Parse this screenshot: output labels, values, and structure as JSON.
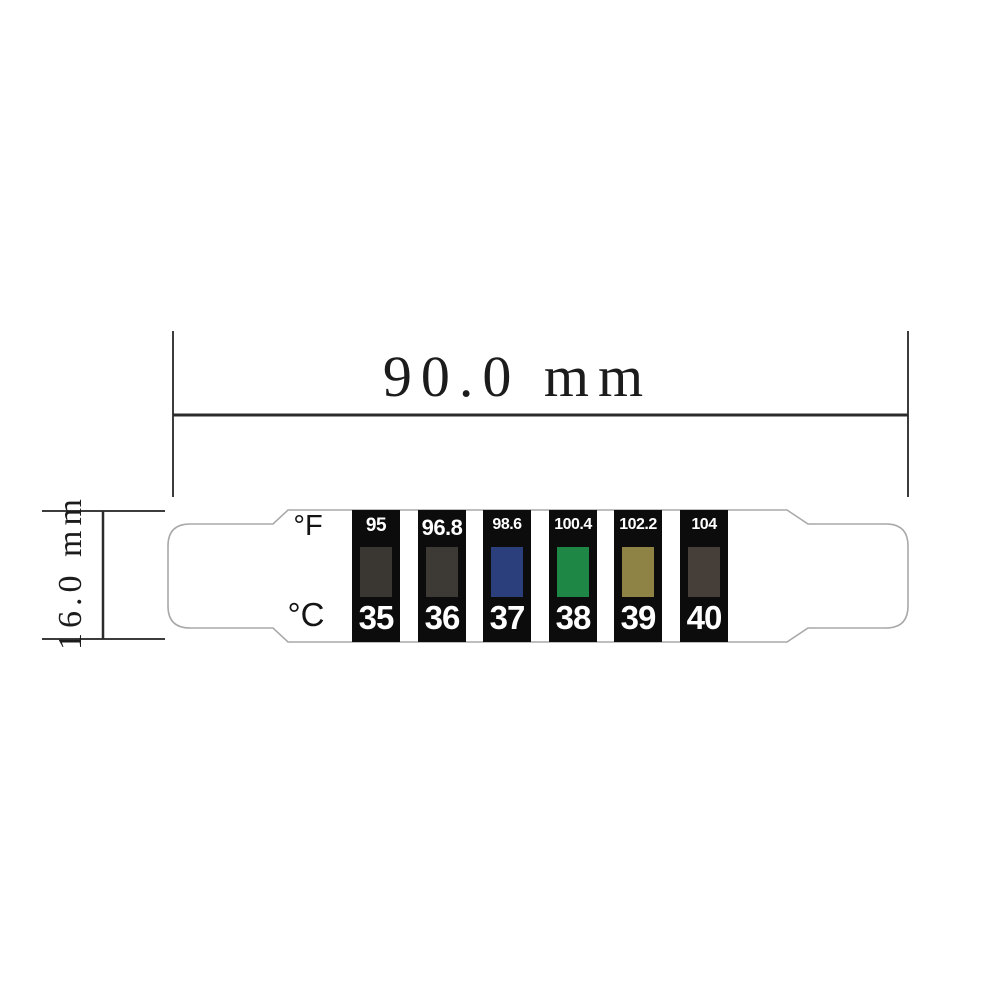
{
  "drawing": {
    "width_dimension": {
      "label": "90.0 mm"
    },
    "height_dimension": {
      "label": "16.0 mm"
    },
    "strip": {
      "fahrenheit_unit": "°F",
      "celsius_unit": "°C",
      "segments": [
        {
          "fahrenheit": "95",
          "celsius": "35",
          "indicator_color": "#3a3631"
        },
        {
          "fahrenheit": "96.8",
          "celsius": "36",
          "indicator_color": "#3d3934"
        },
        {
          "fahrenheit": "98.6",
          "celsius": "37",
          "indicator_color": "#2c3f7d"
        },
        {
          "fahrenheit": "100.4",
          "celsius": "38",
          "indicator_color": "#1f8746"
        },
        {
          "fahrenheit": "102.2",
          "celsius": "39",
          "indicator_color": "#8e8345"
        },
        {
          "fahrenheit": "104",
          "celsius": "40",
          "indicator_color": "#463f39"
        }
      ]
    },
    "colors": {
      "segment_background": "#0c0c0c",
      "strip_outline": "#a9a9a9",
      "dimension_line": "#2b2b2b",
      "extension_line": "#3c3c3c",
      "background": "#ffffff",
      "value_text": "#ffffff",
      "label_text": "#141414"
    }
  }
}
